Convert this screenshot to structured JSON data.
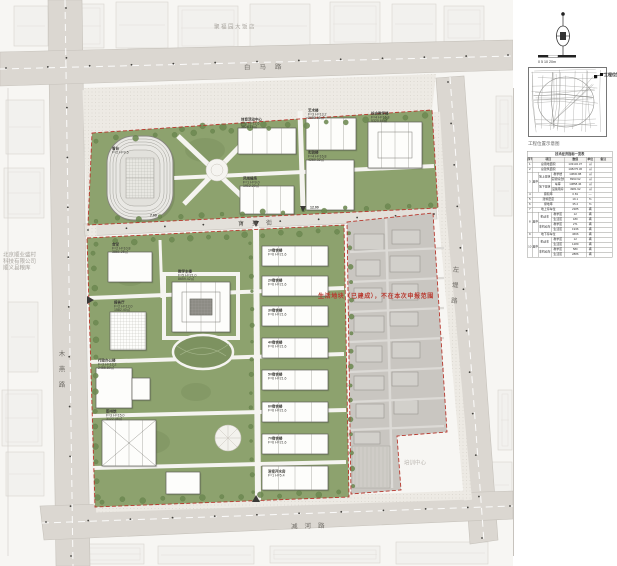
{
  "colors": {
    "site_green": "#8da26e",
    "dark_green": "#7d9260",
    "road_gray": "#dbd7d1",
    "parcel_gray": "#c9c6c1",
    "boundary_red": "#b8382e",
    "paper": "#f7f6f3"
  },
  "roads": {
    "north": "白马路",
    "west": "木燕路",
    "east": "左堤路",
    "campus_street": "育英街",
    "south": "减河路"
  },
  "context": {
    "hotel": "聚福园大饭店",
    "company": [
      "北京顺业盛村",
      "科技有限公司",
      "顺义县粮库"
    ],
    "facility": "培训中心"
  },
  "site": {
    "excluded_note": "生活地块（已建成），不在本次申报范围"
  },
  "annotations": [
    {
      "x": 112,
      "y": 147,
      "lines": [
        "看台",
        "F=2 H=9.5"
      ]
    },
    {
      "x": 241,
      "y": 118,
      "lines": [
        "体育活动中心",
        "F=2 H=12.6",
        "3826.18㎡"
      ]
    },
    {
      "x": 243,
      "y": 177,
      "lines": [
        "风雨操场",
        "F=1 H=9.0",
        "1912.20㎡"
      ]
    },
    {
      "x": 308,
      "y": 109,
      "lines": [
        "艺术楼",
        "F=3 H=13.2",
        "2683.50㎡"
      ]
    },
    {
      "x": 371,
      "y": 112,
      "lines": [
        "综合教学楼",
        "F=4 H=16.8",
        "5320.66㎡"
      ]
    },
    {
      "x": 308,
      "y": 151,
      "lines": [
        "实验楼",
        "F=4 H=16.8",
        "4260.32㎡"
      ]
    },
    {
      "x": 112,
      "y": 243,
      "lines": [
        "食堂",
        "F=2 H=10.8",
        "3861.25㎡"
      ]
    },
    {
      "x": 114,
      "y": 301,
      "lines": [
        "报告厅",
        "F=2 H=12.0",
        "1582.40㎡"
      ]
    },
    {
      "x": 98,
      "y": 359,
      "lines": [
        "行政办公楼",
        "F=3 H=13.2",
        "2455.80㎡"
      ]
    },
    {
      "x": 106,
      "y": 410,
      "lines": [
        "图书馆",
        "F=3 H=15.0",
        "3122.46㎡"
      ]
    },
    {
      "x": 178,
      "y": 270,
      "lines": [
        "教学主楼",
        "F=5 H=21.0",
        "8659.42㎡"
      ]
    },
    {
      "x": 268,
      "y": 249,
      "lines": [
        "1#宿舍楼",
        "F=6 H=21.6"
      ]
    },
    {
      "x": 268,
      "y": 279,
      "lines": [
        "2#宿舍楼",
        "F=6 H=21.6"
      ]
    },
    {
      "x": 268,
      "y": 309,
      "lines": [
        "3#宿舍楼",
        "F=6 H=21.6"
      ]
    },
    {
      "x": 268,
      "y": 341,
      "lines": [
        "4#宿舍楼",
        "F=6 H=21.6"
      ]
    },
    {
      "x": 268,
      "y": 373,
      "lines": [
        "5#宿舍楼",
        "F=6 H=21.6"
      ]
    },
    {
      "x": 268,
      "y": 405,
      "lines": [
        "6#宿舍楼",
        "F=6 H=21.6"
      ]
    },
    {
      "x": 268,
      "y": 437,
      "lines": [
        "7#宿舍楼",
        "F=6 H=21.6"
      ]
    },
    {
      "x": 268,
      "y": 470,
      "lines": [
        "浴室开水房",
        "F=1 H=5.4"
      ]
    },
    {
      "x": 150,
      "y": 214,
      "lines": [
        "7.00"
      ]
    },
    {
      "x": 310,
      "y": 206,
      "lines": [
        "12.00"
      ]
    }
  ],
  "panel": {
    "icons": {
      "north_arrow": "north-arrow-compass-icon",
      "location_marker": "location-marker-icon"
    },
    "scale_label": "0 5 10 20m",
    "map_caption": "工程位置示意图",
    "marker_label": "工程位置",
    "table": {
      "title": "技术经济指标一览表",
      "header": [
        {
          "t": "序号"
        },
        {
          "t": "项目",
          "cs": 3
        },
        {
          "t": "数值"
        },
        {
          "t": "单位"
        },
        {
          "t": "备注"
        }
      ],
      "rows": [
        [
          {
            "t": "1"
          },
          {
            "t": "总用地面积",
            "cs": 3
          },
          {
            "t": "133132.37"
          },
          {
            "t": "㎡"
          },
          {
            "t": ""
          }
        ],
        [
          {
            "t": "2"
          },
          {
            "t": "总建筑面积",
            "cs": 3
          },
          {
            "t": "108275.36"
          },
          {
            "t": "㎡"
          },
          {
            "t": ""
          }
        ],
        [
          {
            "t": "3",
            "rs": 4
          },
          {
            "t": "其中",
            "rs": 4
          },
          {
            "t": "地上建筑",
            "rs": 2
          },
          {
            "t": "教学楼"
          },
          {
            "t": "13830.88"
          },
          {
            "t": "㎡"
          },
          {
            "t": ""
          }
        ],
        [
          {
            "t": "实验综合楼"
          },
          {
            "t": "8993.92"
          },
          {
            "t": "㎡"
          },
          {
            "t": ""
          }
        ],
        [
          {
            "t": "地下建筑",
            "rs": 2
          },
          {
            "t": "车库"
          },
          {
            "t": "13858.46"
          },
          {
            "t": "㎡"
          },
          {
            "t": ""
          }
        ],
        [
          {
            "t": "设备用房"
          },
          {
            "t": "4981.92"
          },
          {
            "t": "㎡"
          },
          {
            "t": ""
          }
        ],
        [
          {
            "t": "4"
          },
          {
            "t": "容积率",
            "cs": 3
          },
          {
            "t": "0.81"
          },
          {
            "t": "—"
          },
          {
            "t": ""
          }
        ],
        [
          {
            "t": "5"
          },
          {
            "t": "建筑密度",
            "cs": 3
          },
          {
            "t": "19.1"
          },
          {
            "t": "%"
          },
          {
            "t": ""
          }
        ],
        [
          {
            "t": "6"
          },
          {
            "t": "绿地率",
            "cs": 3
          },
          {
            "t": "35.2"
          },
          {
            "t": "%"
          },
          {
            "t": ""
          }
        ],
        [
          {
            "t": "7"
          },
          {
            "t": "地上停车位",
            "cs": 3
          },
          {
            "t": "2385"
          },
          {
            "t": "辆"
          },
          {
            "t": ""
          }
        ],
        [
          {
            "t": "8",
            "rs": 4
          },
          {
            "t": "其中",
            "rs": 4
          },
          {
            "t": "机动车",
            "rs": 2
          },
          {
            "t": "教学区"
          },
          {
            "t": "12"
          },
          {
            "t": "辆"
          },
          {
            "t": ""
          }
        ],
        [
          {
            "t": "生活区"
          },
          {
            "t": "180"
          },
          {
            "t": "辆"
          },
          {
            "t": ""
          }
        ],
        [
          {
            "t": "非机动车",
            "rs": 2
          },
          {
            "t": "教学区"
          },
          {
            "t": "271"
          },
          {
            "t": "辆"
          },
          {
            "t": ""
          }
        ],
        [
          {
            "t": "生活区"
          },
          {
            "t": "1936"
          },
          {
            "t": "辆"
          },
          {
            "t": ""
          }
        ],
        [
          {
            "t": "9"
          },
          {
            "t": "地下停车位",
            "cs": 3
          },
          {
            "t": "4666"
          },
          {
            "t": "辆"
          },
          {
            "t": ""
          }
        ],
        [
          {
            "t": "10",
            "rs": 4
          },
          {
            "t": "其中",
            "rs": 4
          },
          {
            "t": "机动车",
            "rs": 2
          },
          {
            "t": "教学区"
          },
          {
            "t": "12"
          },
          {
            "t": "辆"
          },
          {
            "t": ""
          }
        ],
        [
          {
            "t": "生活区"
          },
          {
            "t": "1289"
          },
          {
            "t": "辆"
          },
          {
            "t": ""
          }
        ],
        [
          {
            "t": "非机动车",
            "rs": 2
          },
          {
            "t": "教学区"
          },
          {
            "t": "580"
          },
          {
            "t": "辆"
          },
          {
            "t": ""
          }
        ],
        [
          {
            "t": "生活区"
          },
          {
            "t": "2886"
          },
          {
            "t": "辆"
          },
          {
            "t": ""
          }
        ]
      ]
    }
  }
}
